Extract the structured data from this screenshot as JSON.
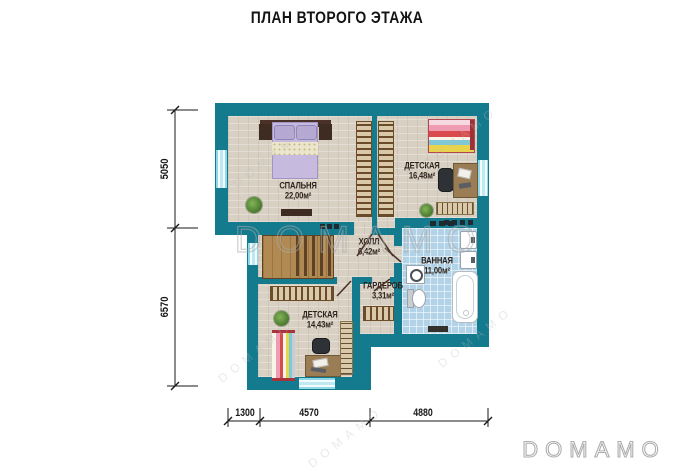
{
  "title": "ПЛАН ВТОРОГО ЭТАЖА",
  "rooms": [
    {
      "name": "СПАЛЬНЯ",
      "area": "22,00м²"
    },
    {
      "name": "ДЕТСКАЯ",
      "area": "16,48м²"
    },
    {
      "name": "ХОЛЛ",
      "area": "6,42м²"
    },
    {
      "name": "ВАННАЯ",
      "area": "11,00м²"
    },
    {
      "name": "ГАРДЕРОБ",
      "area": "3,31м²"
    },
    {
      "name": "ДЕТСКАЯ",
      "area": "14,43м²"
    }
  ],
  "dimensions": {
    "left": [
      "5050",
      "6570"
    ],
    "bottom": [
      "1300",
      "4570",
      "4880"
    ]
  },
  "watermark": {
    "text": "DOMAMO",
    "logo": "DOMAMO"
  },
  "colors": {
    "wall": "#147A8D",
    "floor": "#D9D0C4",
    "tile": "#B2D3E7",
    "wood": "#B08A52",
    "window": "#BFE9F2"
  }
}
